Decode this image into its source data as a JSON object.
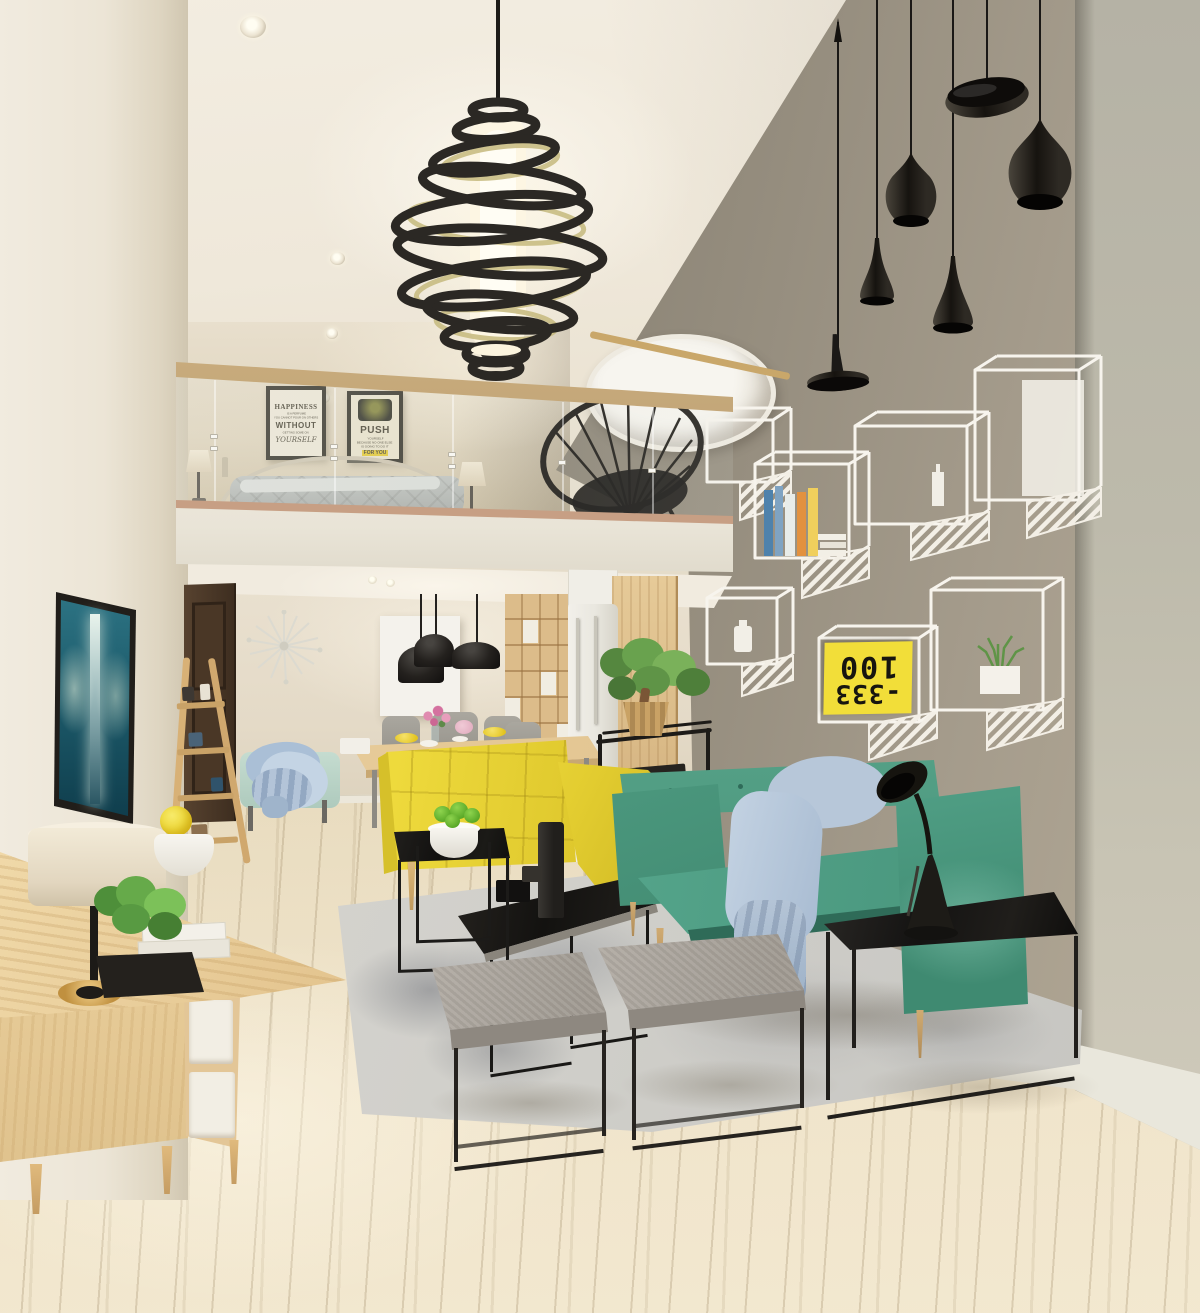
{
  "meta": {
    "domain": "Natural-Image",
    "description": "3D interior render of a modern double-height loft living room with mezzanine bedroom, glass balustrade, spiral ring chandelier, cluster of black pendant lamps on a taupe feature wall with white wireframe cube shelves, yellow and teal sofas, black metal tables, gray ottomans and light wood flooring."
  },
  "posters": {
    "happiness": {
      "line1": "HAPPINESS",
      "line2": "IS A PERFUME",
      "line3": "YOU CANNOT POUR ON OTHERS",
      "line4": "WITHOUT",
      "line5": "GETTING SOME ON",
      "line6": "YOURSELF"
    },
    "push": {
      "line1": "PUSH",
      "line2": "YOURSELF",
      "line3": "BECAUSE NO ONE ELSE",
      "line4": "IS GOING TO DO IT",
      "line5": "FOR YOU"
    }
  },
  "shelf_book": {
    "code_top": "100",
    "code_bottom": "-333"
  },
  "palette": {
    "wall_gray": "#948c7e",
    "wall_cream": "#efe8da",
    "accent_yellow": "#e8d234",
    "accent_teal": "#47947b",
    "wood_light": "#e2c795",
    "metal_black": "#1b1918",
    "throw_blue": "#b7c7d9",
    "rug_gray": "#d7d5d0",
    "floor_wood": "#e4d6b6",
    "shelf_white": "#f6f3ec"
  }
}
